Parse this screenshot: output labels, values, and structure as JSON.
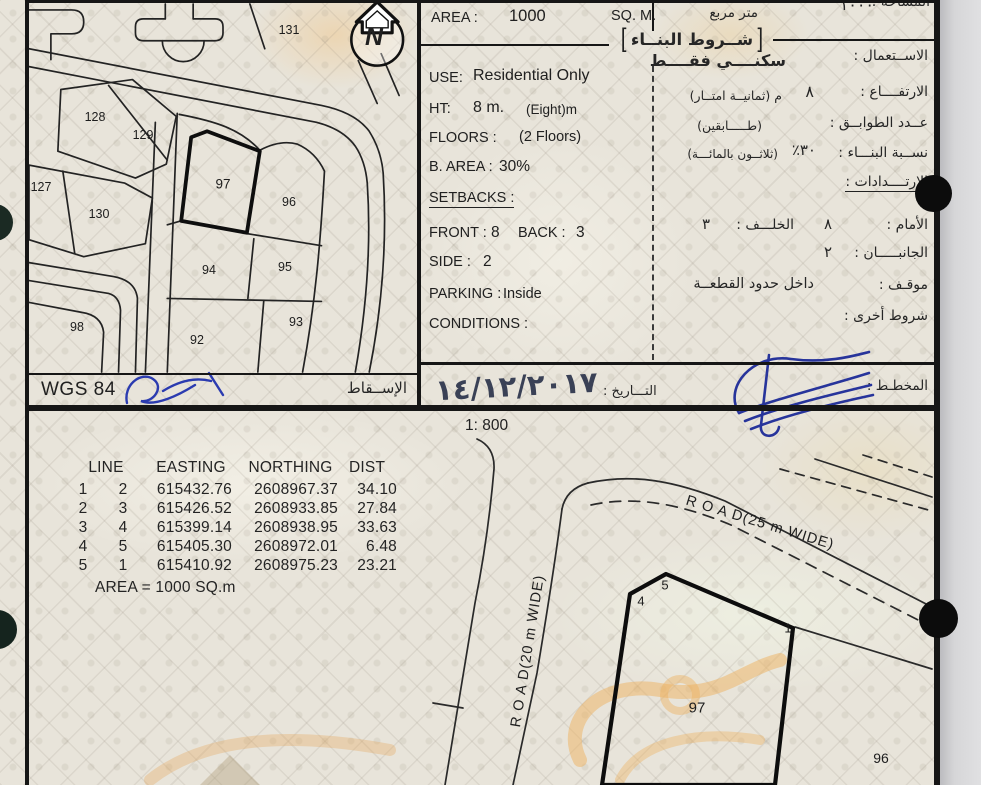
{
  "page": {
    "scale_label": "1: 800",
    "north_label": "N"
  },
  "map": {
    "datum": "WGS 84",
    "projection_ar": "الإســقاط",
    "plots": [
      "131",
      "128",
      "129",
      "127",
      "130",
      "97",
      "96",
      "94",
      "95",
      "98",
      "92",
      "93"
    ]
  },
  "conditions": {
    "area_label": "AREA :",
    "area_value": "1000",
    "area_unit": "SQ. M.",
    "area_unit_ar": "متر مربع",
    "area_value_ar": "١٠٠٠",
    "area_label_ar": "المساحة :",
    "bracket_open": "[",
    "bracket_close": "]",
    "header_ar": "شــروط البنــاء",
    "use_label": "USE:",
    "use_value": "Residential Only",
    "use_label_ar": "الاســتعمال :",
    "use_value_ar": "سكنــــي فقــــط",
    "ht_label": "HT:",
    "ht_value": "8 m.",
    "ht_note": "(Eight)m",
    "ht_label_ar": "الارتفــــاع :",
    "ht_value_ar": "٨",
    "ht_note_ar": "م  (ثمانيــة امتــار)",
    "floors_label": "FLOORS :",
    "floors_value": "(2 Floors)",
    "floors_label_ar": "عــدد الطوابــق :",
    "floors_value_ar": "(طـــــابقين)",
    "barea_label": "B. AREA :",
    "barea_value": "30%",
    "barea_label_ar": "نســبة البنـــاء :",
    "barea_value_ar": "٣٠٪",
    "barea_note_ar": "(ثلاثــون بالمائـــة)",
    "setbacks_label": "SETBACKS :",
    "setbacks_label_ar": "الارتــــدادات :",
    "front_label": "FRONT :",
    "front_value": "8",
    "back_label": "BACK :",
    "back_value": "3",
    "front_label_ar": "الأمام :",
    "front_value_ar": "٨",
    "back_label_ar": "الخلـــف :",
    "back_value_ar": "٣",
    "side_label": "SIDE :",
    "side_value": "2",
    "side_label_ar": "الجانبـــــان :",
    "side_value_ar": "٢",
    "parking_label": "PARKING :",
    "parking_value": "Inside",
    "parking_label_ar": "موقـف :",
    "parking_value_ar": "داخل حدود القطعــة",
    "conditions_label": "CONDITIONS :",
    "conditions_label_ar": "شروط أخرى :"
  },
  "footerbar": {
    "date_label_ar": "التـــاريخ :",
    "date_value": "١٤/١٢/٢٠١٧",
    "planner_label_ar": "المخطـط :"
  },
  "survey_table": {
    "headers": [
      "LINE",
      "EASTING",
      "NORTHING",
      "DIST"
    ],
    "rows": [
      [
        "1",
        "2",
        "615432.76",
        "2608967.37",
        "34.10"
      ],
      [
        "2",
        "3",
        "615426.52",
        "2608933.85",
        "27.84"
      ],
      [
        "3",
        "4",
        "615399.14",
        "2608938.95",
        "33.63"
      ],
      [
        "4",
        "5",
        "615405.30",
        "2608972.01",
        "6.48"
      ],
      [
        "5",
        "1",
        "615410.92",
        "2608975.23",
        "23.21"
      ]
    ],
    "area_note": "AREA = 1000  SQ.m"
  },
  "site_plan": {
    "road_25": "R O A D(25 m WIDE)",
    "road_20": "R O A D(20 m WIDE)",
    "plot_label": "97",
    "neighbor_label": "96",
    "vertex_labels": [
      "4",
      "5",
      "1"
    ]
  }
}
